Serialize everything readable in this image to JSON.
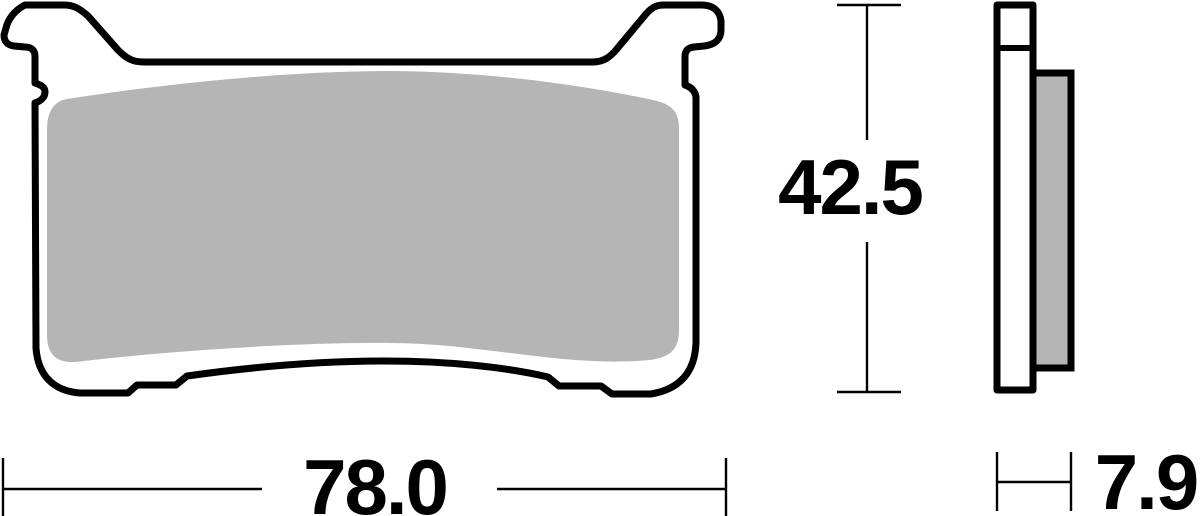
{
  "figure": {
    "subject": "brake-pad-technical-drawing",
    "front_view": "brake-pad-front-profile",
    "side_view": "brake-pad-side-profile"
  },
  "dimensions": {
    "width": {
      "label": "78.0"
    },
    "height": {
      "label": "42.5"
    },
    "thickness": {
      "label": "7.9"
    }
  },
  "colors": {
    "outline": "#000000",
    "friction_material": "#b5b5b5",
    "background": "#ffffff"
  }
}
